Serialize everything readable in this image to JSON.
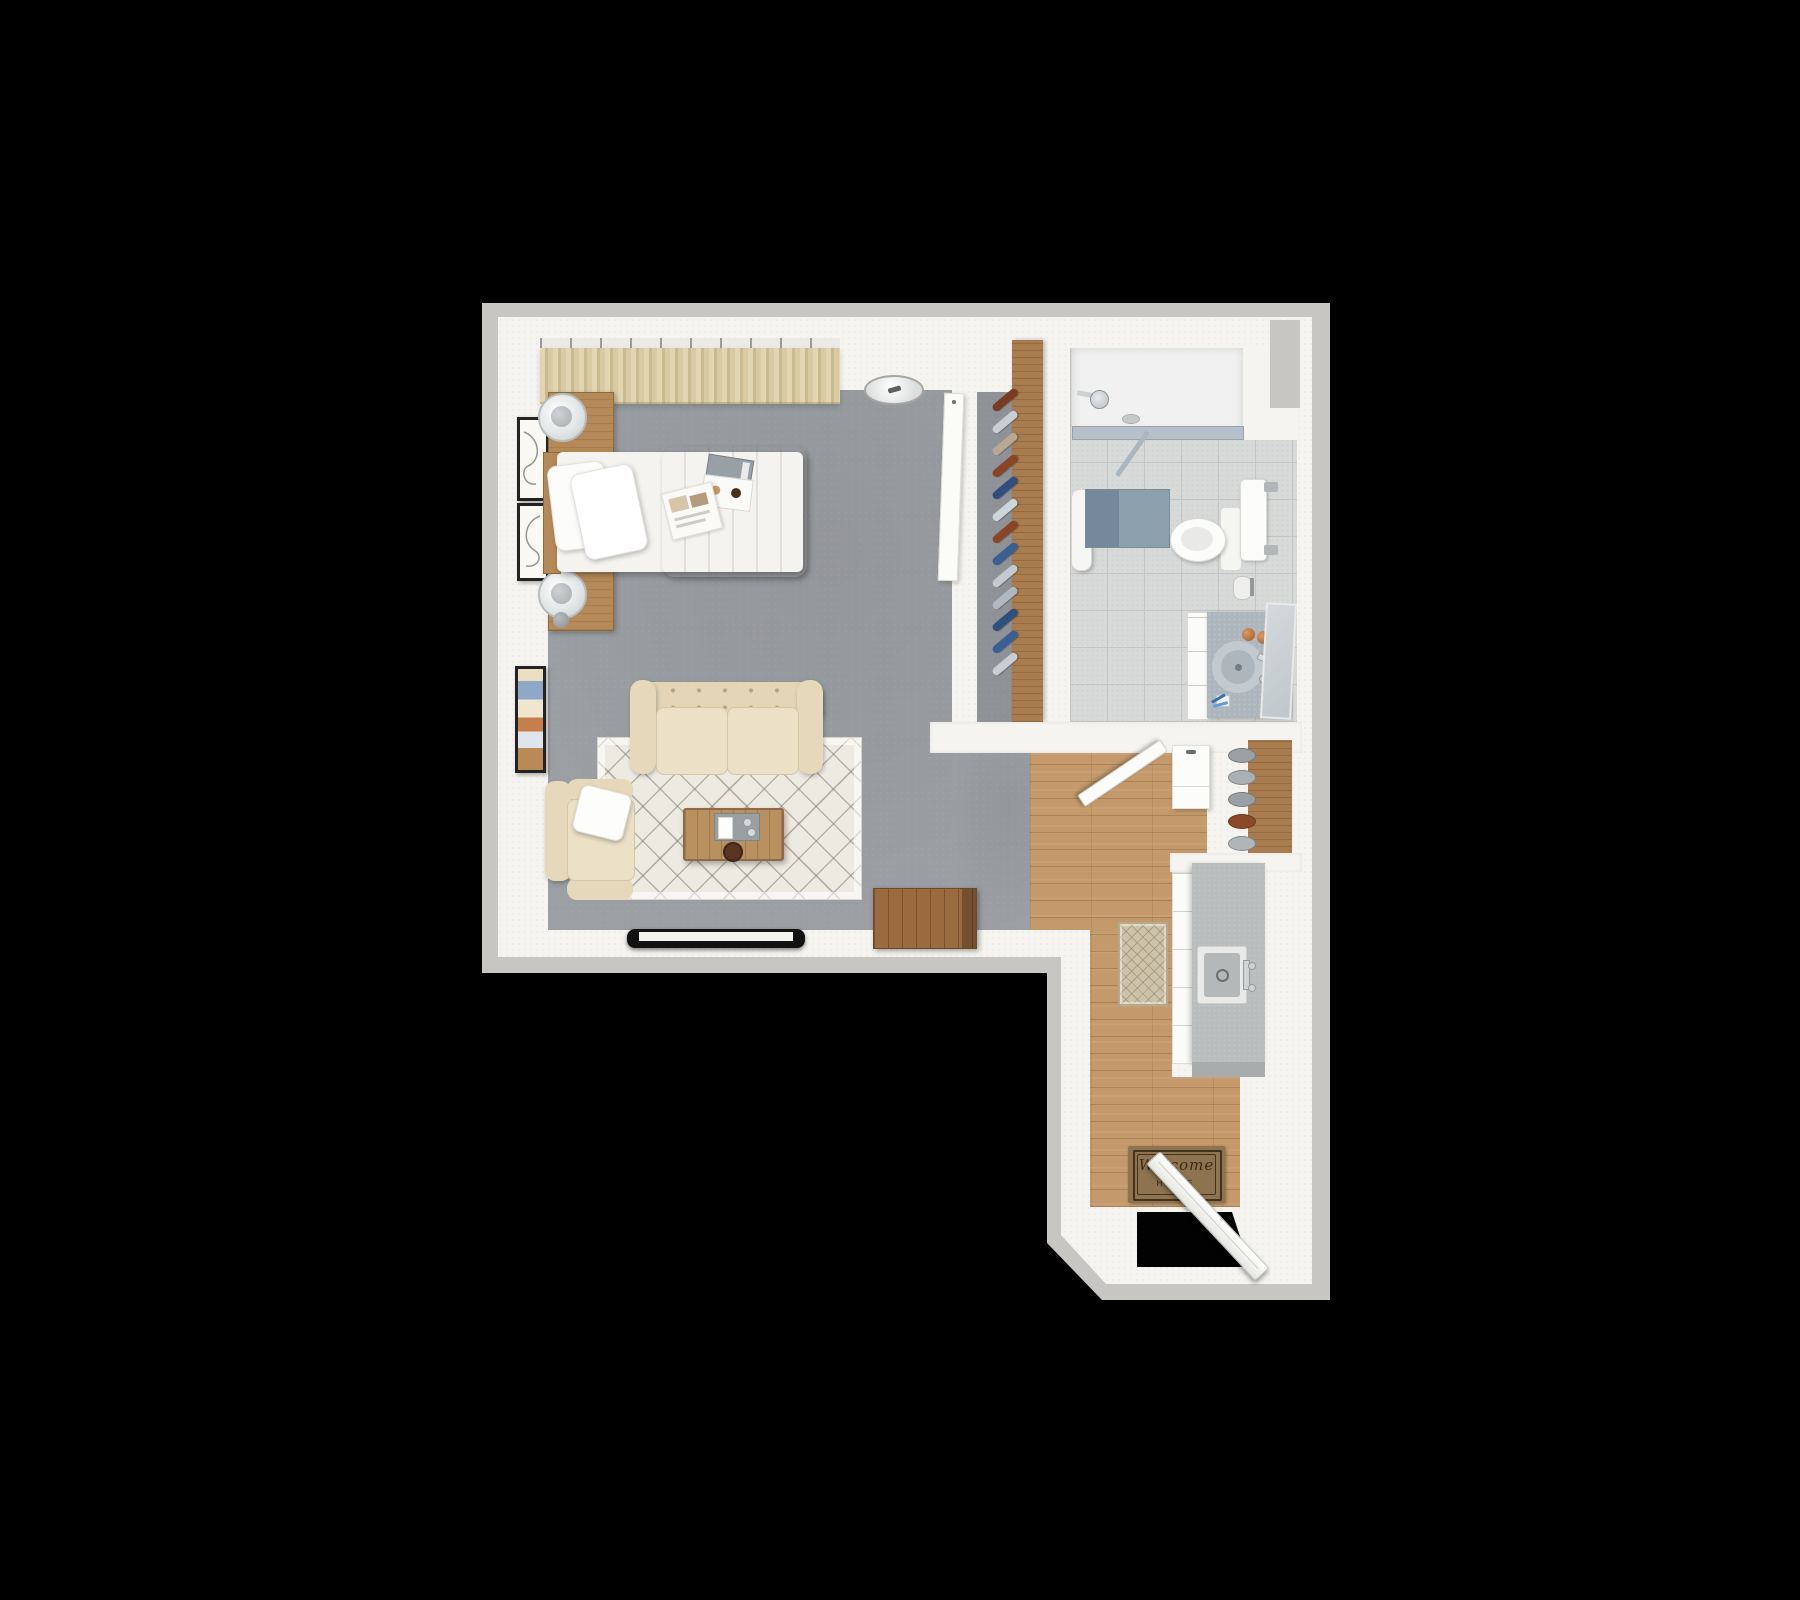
{
  "scene": {
    "description": "3D top-down rendered floor plan of a studio apartment on a black background",
    "background_color": "#000000"
  },
  "doormat": {
    "line1": "Welcome",
    "line2": "HOME",
    "mat_color": "#8d7350",
    "text_color": "#3a2a16"
  },
  "rooms": [
    {
      "id": "living-bedroom",
      "label": "Living / Sleeping Area",
      "floor": "gray carpet",
      "floor_color": "#9b9ea2"
    },
    {
      "id": "closet",
      "label": "Closet",
      "floor": "gray carpet",
      "floor_color": "#8e9195"
    },
    {
      "id": "bathroom",
      "label": "Bathroom",
      "floor": "ceramic tile",
      "floor_color": "#d8dad9"
    },
    {
      "id": "entry-kitchen",
      "label": "Entry / Kitchenette",
      "floor": "oak plank",
      "floor_color": "#c49a6c"
    }
  ],
  "furniture": {
    "bedroom": [
      "curtained window",
      "ceiling light",
      "bed with beige duvet",
      "two nightstands with round lamps",
      "three wall art frames",
      "beige loveseat sofa",
      "armchair with white pillow",
      "patterned area rug",
      "wood coffee table with tray",
      "wall-mounted TV",
      "wood storage crate"
    ],
    "closet": [
      "clothes on hangers",
      "wood wardrobe panel",
      "sliding door panel"
    ],
    "bathroom": [
      "walk-in shower with glass partition",
      "shower head",
      "bath mat",
      "hanging towel",
      "toilet",
      "paper holder",
      "vanity with round sink",
      "mirror",
      "soap dispensers",
      "toothbrush cup"
    ],
    "entry": [
      "bathroom door (open)",
      "laundry cabinet",
      "pantry shelf with stacked bowls",
      "kitchen counter with sink",
      "runner rug",
      "welcome doormat",
      "entry door (open)"
    ]
  },
  "closet_hangers": {
    "colors": [
      "#7a3b22",
      "#c9ced4",
      "#b9a894",
      "#8a4527",
      "#2f4f7f",
      "#cdd5dd",
      "#8a4527",
      "#3a5f95",
      "#c3cad2",
      "#b0b8c0",
      "#2f4f7f",
      "#3a5f95",
      "#c9ced4"
    ]
  },
  "pantry_bowls": {
    "colors": [
      "#9aa0a4",
      "#aab0b4",
      "#9aa0a4",
      "#8a4a2a",
      "#b0b5b8"
    ]
  },
  "palette": {
    "wall_outer": "#c7c6c3",
    "wall_inner": "#f5f4f0",
    "carpet": "#9b9ea2",
    "tile": "#d8dad9",
    "oak_floor": "#c49a6c",
    "wood_furniture": "#b68a58",
    "sofa_beige": "#e6d8bb",
    "duvet": "#cfc0b6",
    "bath_mat": "#8da0ae",
    "kitchen_counter": "#b9bdbd",
    "vanity_counter": "#aeb6bd"
  }
}
